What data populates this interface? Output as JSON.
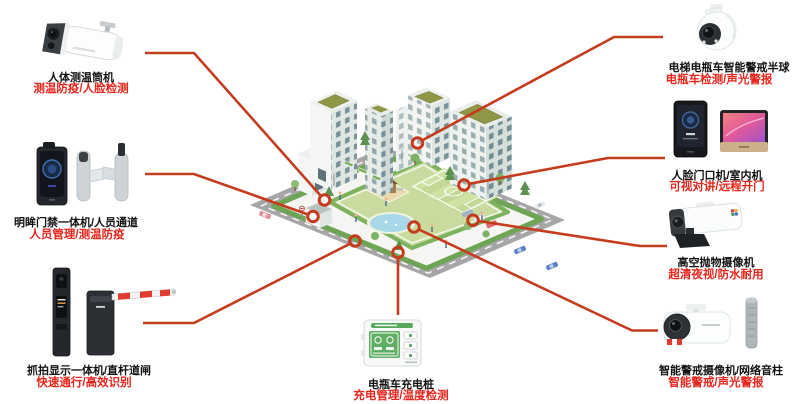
{
  "palette": {
    "callout_line": "#c53b1e",
    "title_text": "#111111",
    "subtitle_text": "#e8251c",
    "background": "#ffffff",
    "lawn_green": "#c9db9f",
    "hedge_green": "#6ea554",
    "road_gray": "#a6a6a6",
    "roof_olive": "#8f9646",
    "pond_blue": "#a9d9e8"
  },
  "devices": [
    {
      "icon": "thermal-bullet-camera",
      "title": "人体测温筒机",
      "subtitle": "测温防疫/人脸检测"
    },
    {
      "icon": "face-access-terminal-turnstile",
      "title": "明眸门禁一体机/人员通道",
      "subtitle": "人员管理/测温防疫"
    },
    {
      "icon": "capture-display-pillar-barrier-gate",
      "title": "抓拍显示一体机/直杆道闸",
      "subtitle": "快速通行/高效识别"
    },
    {
      "icon": "smart-warning-dome-camera",
      "title": "电梯电瓶车智能警戒半球",
      "subtitle": "电瓶车检测/声光警报"
    },
    {
      "icon": "face-door-station-indoor-monitor",
      "title": "人脸门口机/室内机",
      "subtitle": "可视对讲/远程开门"
    },
    {
      "icon": "high-altitude-throwing-camera",
      "title": "高空抛物摄像机",
      "subtitle": "超清夜视/防水耐用"
    },
    {
      "icon": "smart-warning-bullet-camera-sound-column",
      "title": "智能警戒摄像机/网络音柱",
      "subtitle": "智能警戒/声光警报"
    },
    {
      "icon": "ebike-charging-pile",
      "title": "电瓶车充电桩",
      "subtitle": "充电管理/温度检测"
    }
  ]
}
